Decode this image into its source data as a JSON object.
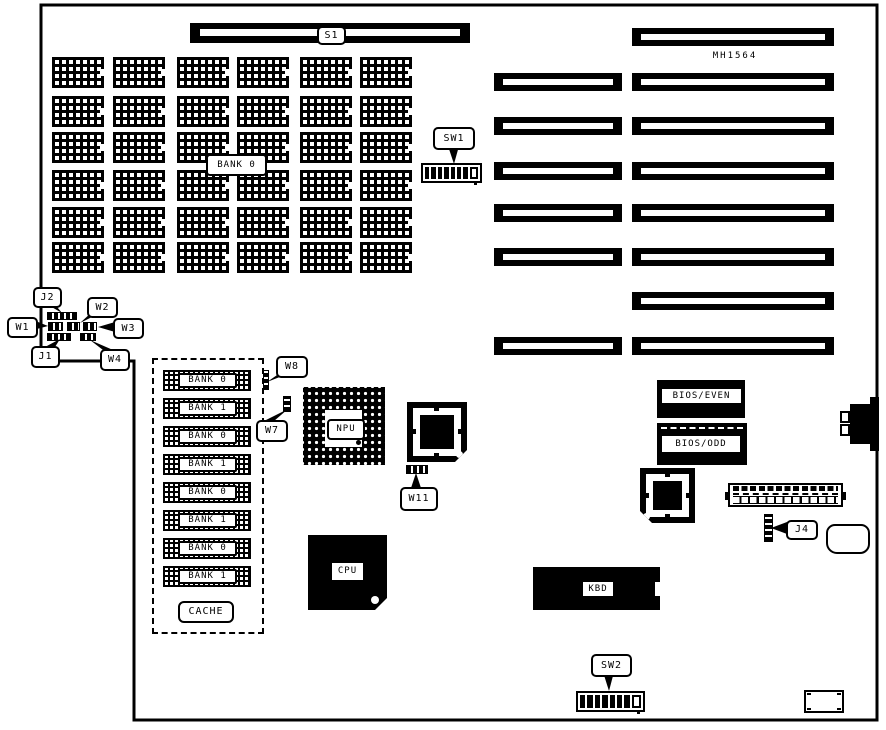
{
  "colors": {
    "ink": "#000000",
    "paper": "#ffffff"
  },
  "board": {
    "model": "MH1564"
  },
  "switch_bar": {
    "label": "S1"
  },
  "memory_array": {
    "bank_label": "BANK 0",
    "rows": 6,
    "cols": 6
  },
  "dip_switches": {
    "sw1": {
      "label": "SW1",
      "positions": [
        1,
        1,
        1,
        1,
        1,
        1,
        1,
        0
      ]
    },
    "sw2": {
      "label": "SW2",
      "positions": [
        1,
        1,
        1,
        1,
        1,
        1,
        1,
        0
      ]
    }
  },
  "jumpers": {
    "j1": "J1",
    "j2": "J2",
    "j4": "J4",
    "w1": "W1",
    "w2": "W2",
    "w3": "W3",
    "w4": "W4",
    "w7": "W7",
    "w8": "W8",
    "w11": "W11"
  },
  "chips": {
    "npu": "NPU",
    "cpu": "CPU",
    "kbd": "KBD",
    "bios_even": "BIOS/EVEN",
    "bios_odd": "BIOS/ODD"
  },
  "cache": {
    "label": "CACHE",
    "chips": [
      "BANK 0",
      "BANK 1",
      "BANK 0",
      "BANK 1",
      "BANK 0",
      "BANK 1",
      "BANK 0",
      "BANK 1"
    ]
  },
  "expansion_slots": {
    "left_column_count": 6,
    "right_column_count": 8
  }
}
